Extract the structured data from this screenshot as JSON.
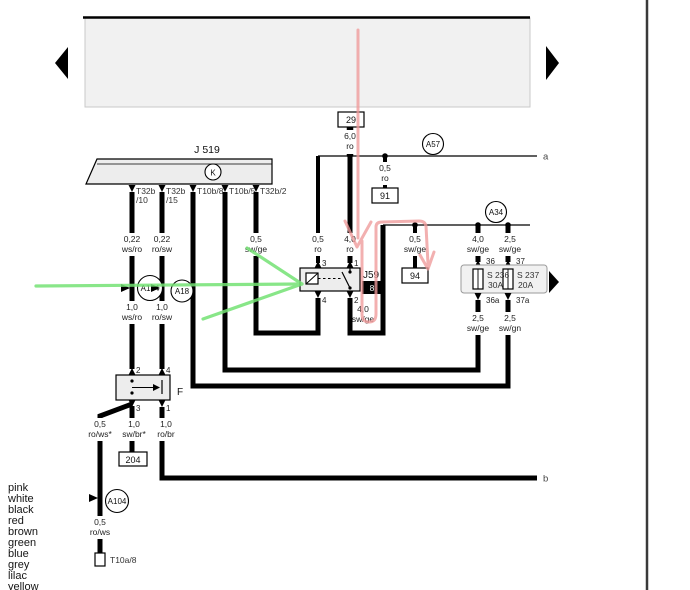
{
  "colors": {
    "annotation_pink": "#ef9a9a",
    "annotation_green": "#74e274",
    "band_fill": "#f1f1f1",
    "component_fill": "#ededed"
  },
  "markers": {
    "a": "a",
    "b": "b"
  },
  "control_unit": {
    "label": "J 519",
    "badge": "K",
    "terminals": [
      {
        "line1": "T32b",
        "line2": "/10"
      },
      {
        "line1": "T32b",
        "line2": "/15"
      },
      {
        "line1": "T10b/8",
        "line2": ""
      },
      {
        "line1": "T10b/5",
        "line2": ""
      },
      {
        "line1": "T32b/2",
        "line2": ""
      }
    ]
  },
  "relay": {
    "label": "J59",
    "slot": "8",
    "pin_top_left": "3",
    "pin_top_right": "1",
    "pin_bottom_left": "4",
    "pin_bottom_right": "2"
  },
  "switch_f": {
    "label": "F",
    "pin_top_left": "2",
    "pin_top_right": "4",
    "pin_bottom_left": "3",
    "pin_bottom_right": "1"
  },
  "connectors": {
    "c29": "29",
    "c91": "91",
    "c94": "94",
    "c204": "204"
  },
  "refs": {
    "a57": "A57",
    "a34": "A34",
    "a154": "A154",
    "a18": "A18",
    "a104": "A104"
  },
  "fuse_panel": {
    "fuses": [
      {
        "name": "S 236",
        "rating": "30A",
        "terminal_top": "36",
        "terminal_bottom": "36a"
      },
      {
        "name": "S 237",
        "rating": "20A",
        "terminal_top": "37",
        "terminal_bottom": "37a"
      }
    ]
  },
  "bottom_terminal": "T10a/8",
  "wire_labels": {
    "c1_upper": {
      "gauge": "0,22",
      "code": "ws/ro"
    },
    "c2_upper": {
      "gauge": "0,22",
      "code": "ro/sw"
    },
    "c5_upper": {
      "gauge": "0,5",
      "code": "sw/ge"
    },
    "c1_lower": {
      "gauge": "1,0",
      "code": "ws/ro"
    },
    "c2_lower": {
      "gauge": "1,0",
      "code": "ro/sw"
    },
    "feed": {
      "gauge": "6,0",
      "code": "ro"
    },
    "relay_coil": {
      "gauge": "0,5",
      "code": "ro"
    },
    "relay_supply": {
      "gauge": "4,0",
      "code": "ro"
    },
    "to_91": {
      "gauge": "0,5",
      "code": "ro"
    },
    "relay_out": {
      "gauge": "4,0",
      "code": "sw/ge"
    },
    "to_94": {
      "gauge": "0,5",
      "code": "sw/ge"
    },
    "fuse36_in": {
      "gauge": "4,0",
      "code": "sw/ge"
    },
    "fuse37_in": {
      "gauge": "2,5",
      "code": "sw/ge"
    },
    "fuse36_out": {
      "gauge": "2,5",
      "code": "sw/ge"
    },
    "fuse37_out": {
      "gauge": "2,5",
      "code": "sw/gn"
    },
    "f_out_left": {
      "gauge": "0,5",
      "code": "ro/ws*"
    },
    "f_out_mid": {
      "gauge": "1,0",
      "code": "sw/br*"
    },
    "f_out_right": {
      "gauge": "1,0",
      "code": "ro/br"
    },
    "ground_run": {
      "gauge": "0,5",
      "code": "ro/ws"
    }
  },
  "legend": {
    "items": [
      "pink",
      "white",
      "black",
      "red",
      "brown",
      "green",
      "blue",
      "grey",
      "lilac",
      "yellow"
    ]
  }
}
